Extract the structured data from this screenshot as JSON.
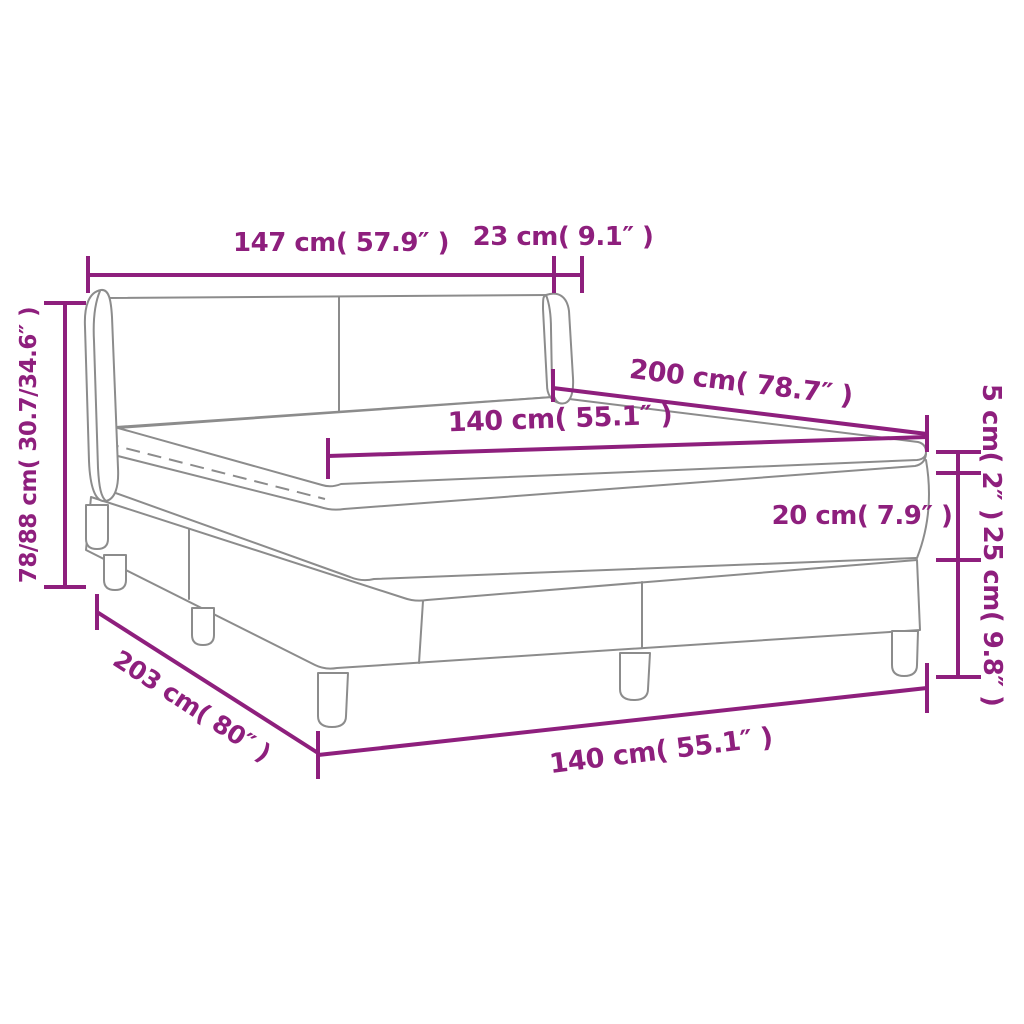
{
  "diagram": {
    "title": "box-spring-bed-dimension-diagram",
    "subject": "box spring bed with headboard, mattress topper, mattress and legged base",
    "colors": {
      "dimension_accent": "#8E1F7D",
      "line_art": "#8C8C8C",
      "background": "#FFFFFF"
    },
    "measurements": [
      {
        "name": "headboard-width",
        "text": "147 cm( 57.9″ )",
        "x": 341,
        "y": 243,
        "rotation": 0,
        "size": 26
      },
      {
        "name": "headboard-wing-depth",
        "text": "23 cm( 9.1″ )",
        "x": 563,
        "y": 237,
        "rotation": 0,
        "size": 26
      },
      {
        "name": "overall-height",
        "text": "78/88 cm( 30.7/34.6″ )",
        "x": 29,
        "y": 445,
        "rotation": -90,
        "size": 23
      },
      {
        "name": "bed-length",
        "text": "200 cm( 78.7″ )",
        "x": 741,
        "y": 383,
        "rotation": 7,
        "size": 27
      },
      {
        "name": "mattress-width-top",
        "text": "140 cm( 55.1″ )",
        "x": 560,
        "y": 419,
        "rotation": -2,
        "size": 27
      },
      {
        "name": "mattress-thickness",
        "text": "20 cm( 7.9″ )",
        "x": 862,
        "y": 516,
        "rotation": 0,
        "size": 26
      },
      {
        "name": "topper-thickness",
        "text": "5 cm( 2″ )",
        "x": 991,
        "y": 452,
        "rotation": 90,
        "size": 26
      },
      {
        "name": "base-leg-height",
        "text": "25 cm( 9.8″ )",
        "x": 992,
        "y": 616,
        "rotation": 90,
        "size": 26
      },
      {
        "name": "overall-length",
        "text": "203 cm( 80″ )",
        "x": 192,
        "y": 706,
        "rotation": 33,
        "size": 25
      },
      {
        "name": "mattress-width-bottom",
        "text": "140 cm( 55.1″ )",
        "x": 661,
        "y": 751,
        "rotation": -7,
        "size": 27
      }
    ]
  }
}
